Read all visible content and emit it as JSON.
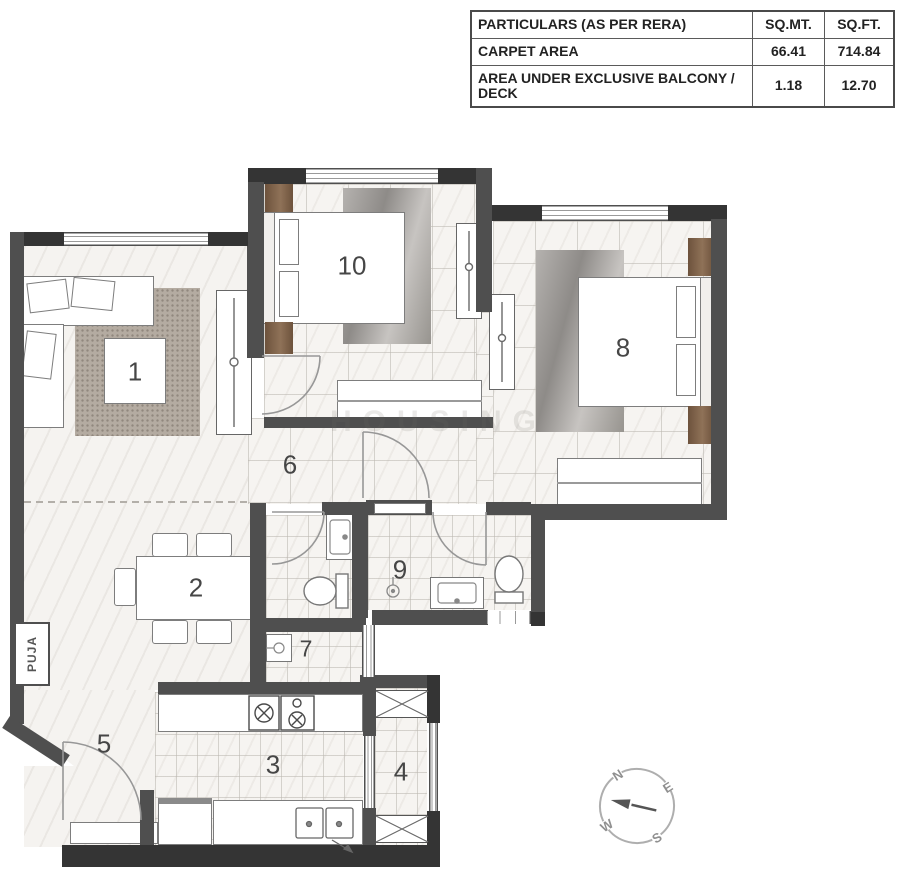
{
  "table": {
    "headers": {
      "particulars": "PARTICULARS (AS PER RERA)",
      "sqmt": "SQ.MT.",
      "sqft": "SQ.FT."
    },
    "rows": [
      {
        "particulars": "CARPET AREA",
        "sqmt": "66.41",
        "sqft": "714.84"
      },
      {
        "particulars": "AREA UNDER EXCLUSIVE BALCONY / DECK",
        "sqmt": "1.18",
        "sqft": "12.70"
      }
    ]
  },
  "plan": {
    "room_labels": [
      "1",
      "2",
      "3",
      "4",
      "5",
      "6",
      "7",
      "8",
      "9",
      "10"
    ],
    "puja": "PUJA",
    "watermark": "HOUSING",
    "compass": {
      "north": "N",
      "east": "E",
      "south": "S",
      "west": "W"
    },
    "colors": {
      "wall": "#4f4f4f",
      "wall_dark": "#343434",
      "wood_accent": "#85674e",
      "floor": "#f5f3f0",
      "living_rug": "#b4aba1",
      "bedroom_rug": "#9a9794"
    }
  }
}
